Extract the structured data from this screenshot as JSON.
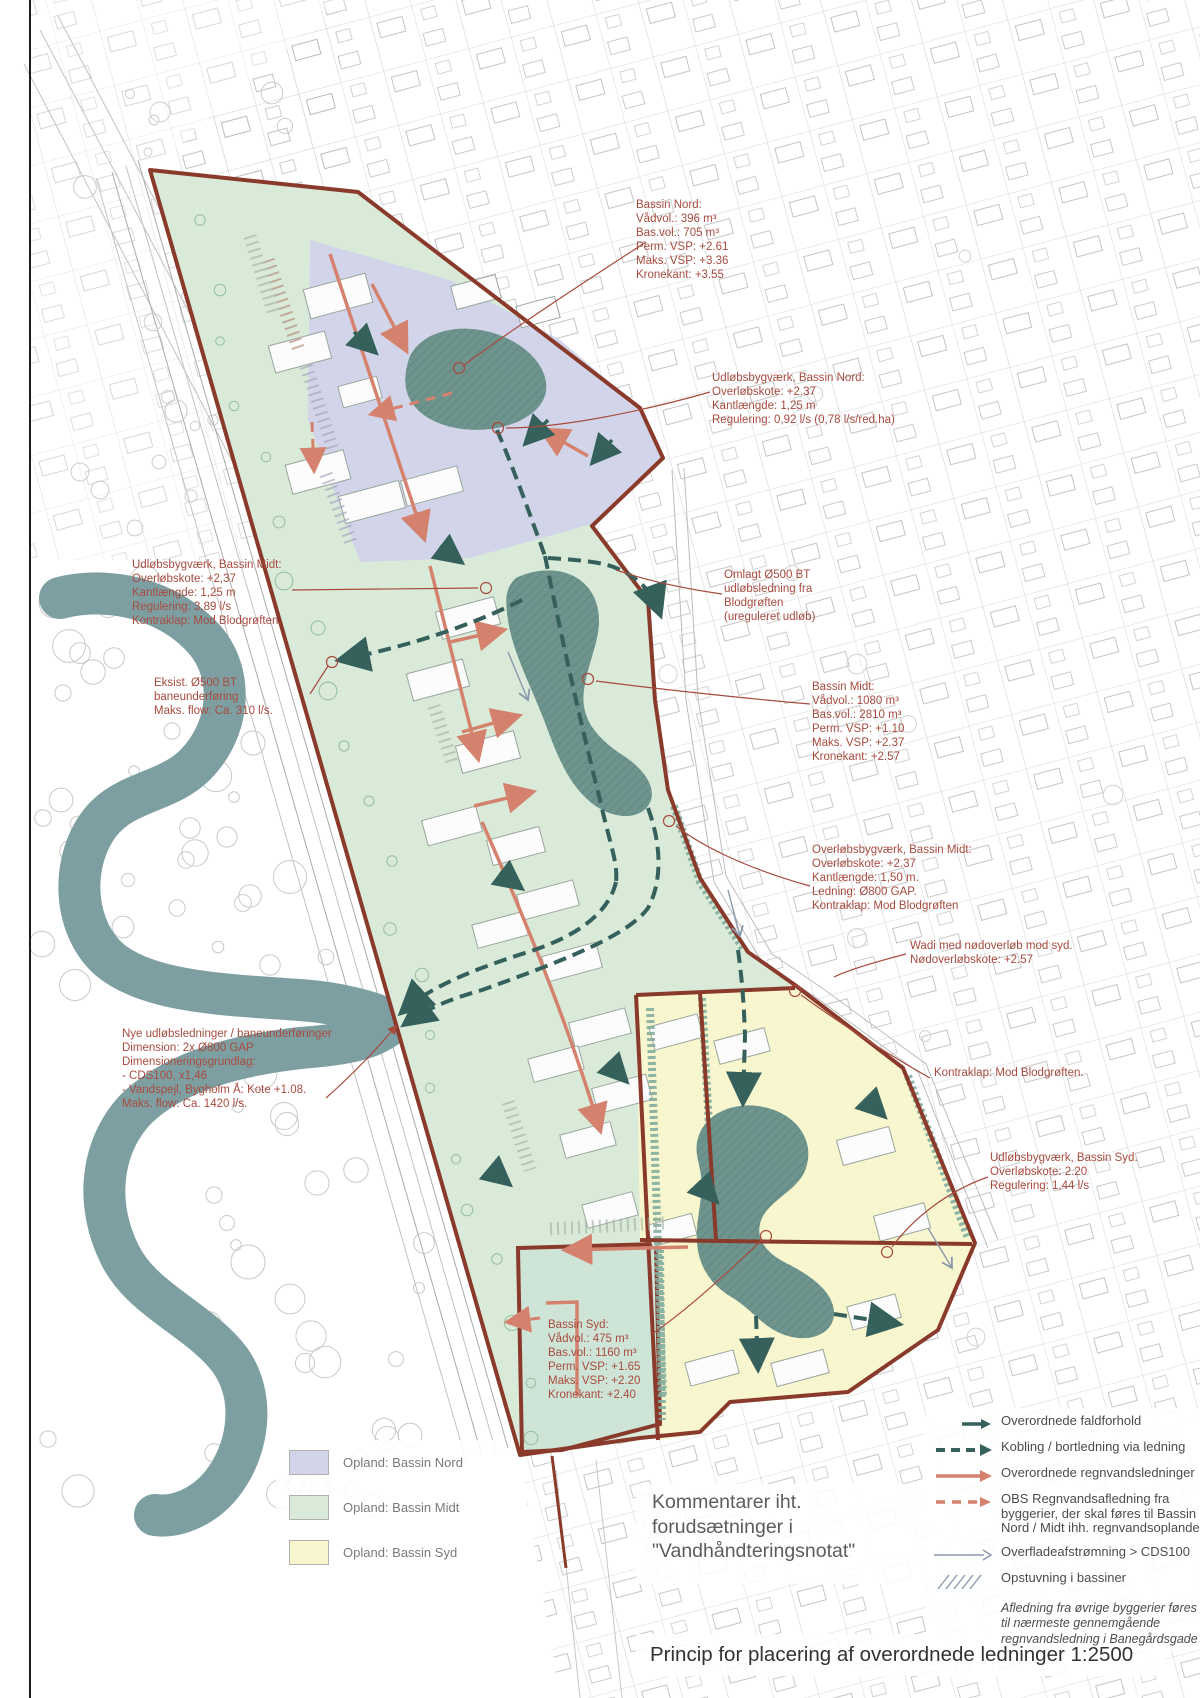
{
  "page": {
    "title_comment": "Kommentarer iht.\nforudsætninger i\n\"Vandhåndteringsnotat\"",
    "title_main": "Princip for placering af overordnede ledninger 1:2500"
  },
  "colors": {
    "zone_nord": "#d2d5e9",
    "zone_midt": "#d9ead9",
    "zone_syd": "#f8f6cf",
    "water": "#7d9fa2",
    "basin": "#6e948d",
    "boundary_red": "#8a3a2b",
    "pipe_salmon": "#d4826d",
    "pipe_teal": "#35605c",
    "annotation_red": "#a84b3f",
    "surface_arrow_gray": "#8b99ad"
  },
  "annotations": {
    "bassin_nord": {
      "text": "Bassin Nord:\nVådvol.: 396 m³\nBas.vol.: 705 m³\nPerm. VSP: +2.61\nMaks. VSP: +3.36\nKronekant: +3.55"
    },
    "udlobs_nord": {
      "text": "Udløbsbygværk, Bassin Nord:\nOverløbskote: +2.37\nKantlængde: 1,25 m\nRegulering: 0,92 l/s (0,78 l/s/red.ha)"
    },
    "udlobs_midt": {
      "text": "Udløbsbygværk, Bassin Midt:\nOverløbskote: +2,37\nKantlængde: 1,25 m\nRegulering: 3,89 l/s\nKontraklap: Mod Blodgrøften."
    },
    "eksist": {
      "text": "Eksist. Ø500 BT\nbaneunderføring\nMaks. flow: Ca. 310 l/s."
    },
    "omlagt": {
      "text": "Omlagt Ø500 BT\nudløbsledning fra\nBlodgrøften\n(ureguleret udløb)"
    },
    "bassin_midt": {
      "text": "Bassin Midt:\nVådvol.: 1080 m³\nBas.vol.: 2810 m³\nPerm. VSP: +1.10\nMaks. VSP: +2.37\nKronekant: +2.57"
    },
    "overlobs_midt": {
      "text": "Overløbsbygværk, Bassin Midt:\nOverløbskote: +2.37\nKantlængde: 1,50 m.\nLedning: Ø800 GAP.\nKontraklap: Mod Blodgrøften"
    },
    "wadi": {
      "text": "Wadi med nødoverløb mod syd.\nNødoverløbskote: +2.57"
    },
    "nye": {
      "text": "Nye udløbsledninger / baneunderføringer\nDimension: 2x Ø800 GAP\nDimensioneringsgrundlag:\n- CDS100, x1,46\n- Vandspejl, Bygholm Å: Kote +1.08.\nMaks. flow: Ca. 1420 l/s."
    },
    "kontraklap": {
      "text": "Kontraklap: Mod Blodgrøften."
    },
    "udlobs_syd": {
      "text": "Udløbsbygværk, Bassin Syd.\nOverløbskote: 2.20\nRegulering: 1,44 l/s"
    },
    "bassin_syd": {
      "text": "Bassin Syd:\nVådvol.: 475 m³\nBas.vol.: 1160 m³\nPerm. VSP: +1.65\nMaks. VSP: +2.20\nKronekant: +2.40"
    }
  },
  "legend_zones": {
    "items": [
      {
        "label": "Opland: Bassin Nord"
      },
      {
        "label": "Opland: Bassin Midt"
      },
      {
        "label": "Opland: Bassin Syd"
      }
    ]
  },
  "legend_symbols": {
    "items": [
      {
        "label": "Overordnede faldforhold"
      },
      {
        "label": "Kobling / bortledning via ledning"
      },
      {
        "label": "Overordnede regnvandsledninger"
      },
      {
        "label": "OBS Regnvandsafledning fra byggerier, der skal føres til Bassin Nord / Midt ihh. regnvandsoplande."
      },
      {
        "label": "Overfladeafstrømning > CDS100"
      },
      {
        "label": "Opstuvning i bassiner"
      }
    ],
    "note": "Afledning fra øvrige byggerier føres\ntil nærmeste gennemgående\nregnvandsledning i Banegårdsgade"
  }
}
